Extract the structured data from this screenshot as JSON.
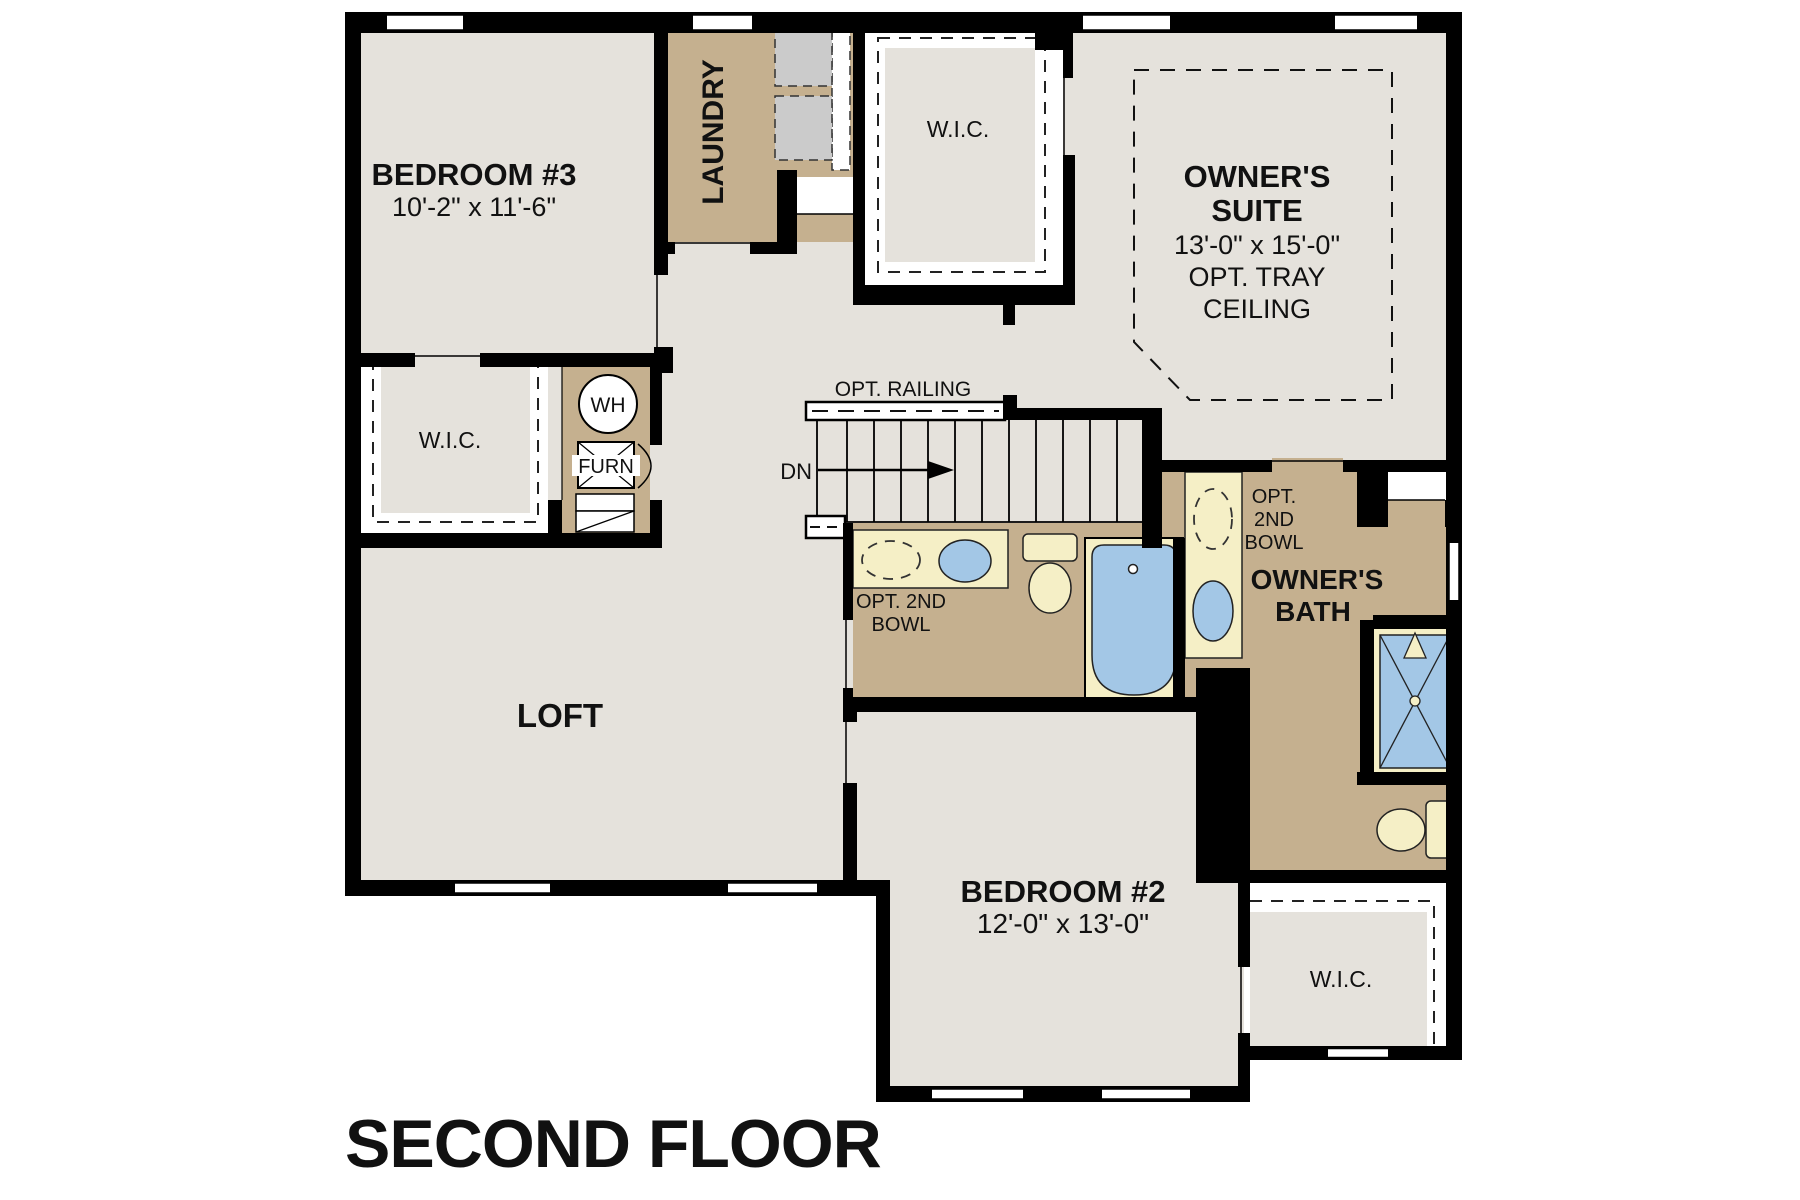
{
  "title": "SECOND FLOOR",
  "colors": {
    "wall": "#000000",
    "floor": "#e5e2dc",
    "wet_room_floor": "#c5b08f",
    "fixture_cream": "#f5efc6",
    "fixture_blue": "#a3c7e6",
    "appliance_gray": "#cbcbcb",
    "background": "#ffffff"
  },
  "rooms": {
    "bedroom3": {
      "name": "BEDROOM #3",
      "dims": "10'-2\" x 11'-6\""
    },
    "laundry": {
      "name": "LAUNDRY"
    },
    "wic_bedroom3": {
      "name": "W.I.C."
    },
    "wic_owners": {
      "name": "W.I.C."
    },
    "wic_bedroom2": {
      "name": "W.I.C."
    },
    "owners_suite": {
      "name_line1": "OWNER'S",
      "name_line2": "SUITE",
      "dims": "13'-0\" x 15'-0\"",
      "opt_line1": "OPT. TRAY",
      "opt_line2": "CEILING"
    },
    "loft": {
      "name": "LOFT"
    },
    "bedroom2": {
      "name": "BEDROOM #2",
      "dims": "12'-0\" x 13'-0\""
    },
    "owners_bath": {
      "name_line1": "OWNER'S",
      "name_line2": "BATH",
      "opt_bowl_line1": "OPT.",
      "opt_bowl_line2": "2ND",
      "opt_bowl_line3": "BOWL"
    },
    "hall_bath": {
      "opt_bowl_line1": "OPT. 2ND",
      "opt_bowl_line2": "BOWL"
    }
  },
  "stairs": {
    "direction": "DN",
    "railing_note": "OPT. RAILING"
  },
  "equipment": {
    "water_heater": "WH",
    "furnace": "FURN"
  }
}
